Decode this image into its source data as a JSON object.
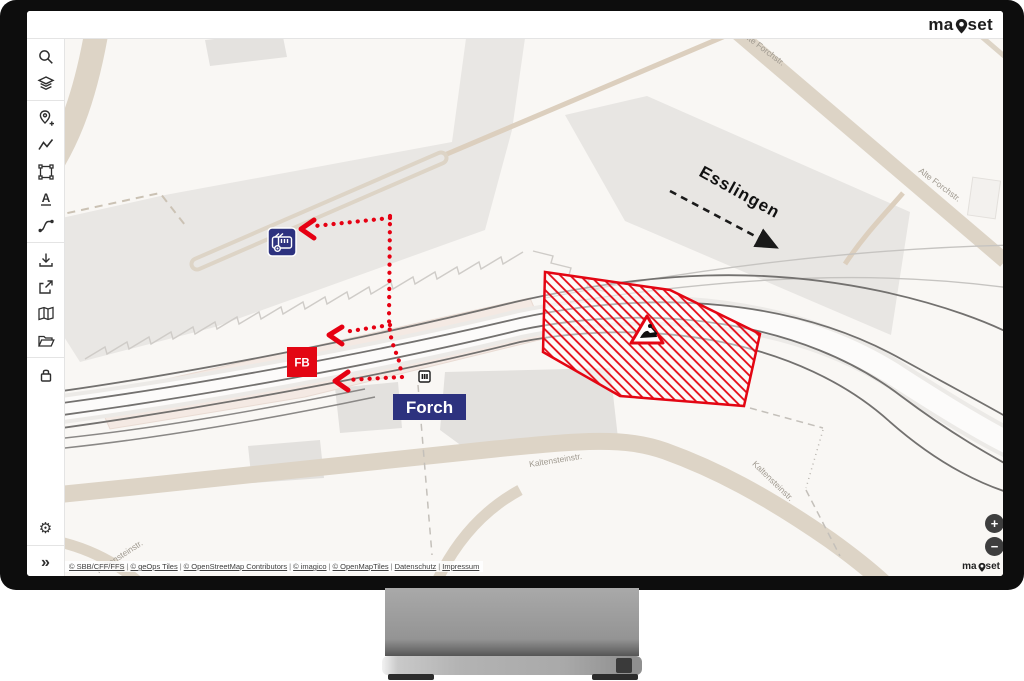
{
  "brand": {
    "name": "mapset",
    "prefix": "ma",
    "suffix": "set"
  },
  "toolbar": {
    "icons": [
      "search",
      "layers",
      "add-location",
      "draw-line",
      "draw-polygon",
      "add-text",
      "draw-route",
      "download",
      "share",
      "map-view",
      "open-folder",
      "lock",
      "settings",
      "expand"
    ],
    "text_tool_glyph": "A",
    "settings_glyph": "⚙",
    "expand_glyph": "»"
  },
  "map": {
    "labels": {
      "esslingen": "Esslingen",
      "forch": "Forch",
      "fb_marker": "FB",
      "alte_forchstr": "Alte Forchstr.",
      "kaltensteinstr": "Kaltensteinstr."
    }
  },
  "zoom_controls": {
    "zoom_in": "+",
    "zoom_out": "−"
  },
  "attribution": {
    "separator": "|",
    "links": [
      "© SBB/CFF/FFS",
      "© geOps Tiles",
      "© OpenStreetMap Contributors",
      "© imagico",
      "© OpenMapTiles",
      "Datenschutz",
      "Impressum"
    ]
  },
  "colors": {
    "accent_red": "#e30613",
    "dot_red": "#e60012",
    "rail_blue": "#2d327f",
    "road_tan": "#ddd4c6"
  }
}
